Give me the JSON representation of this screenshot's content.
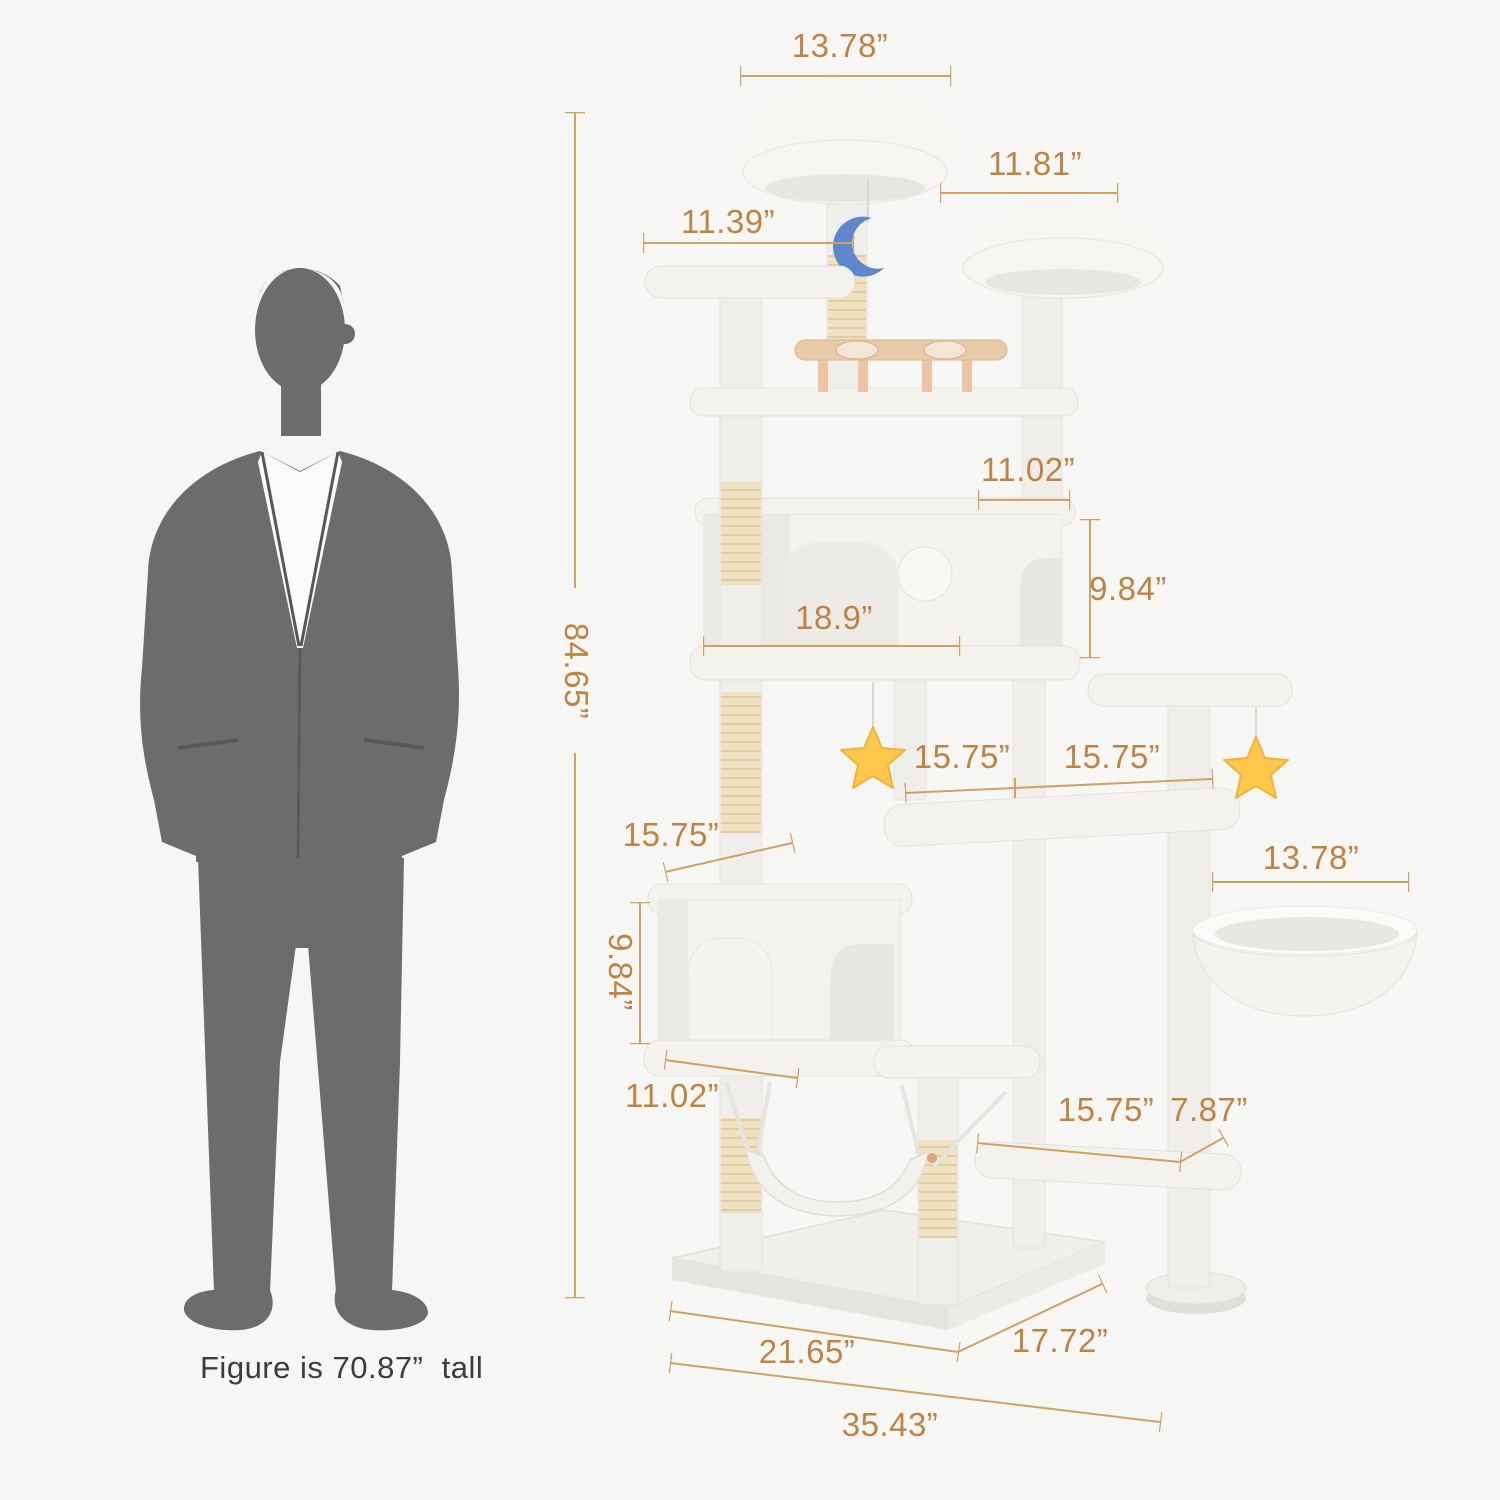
{
  "figure_note": "Figure is 70.87”  tall",
  "dimensions": [
    {
      "id": "top-cloud-width",
      "label": "13.78”"
    },
    {
      "id": "second-cloud-width",
      "label": "11.81”"
    },
    {
      "id": "left-platform-width",
      "label": "11.39”"
    },
    {
      "id": "total-height",
      "label": "84.65”"
    },
    {
      "id": "upper-condo-top-width",
      "label": "11.02”"
    },
    {
      "id": "upper-condo-height",
      "label": "9.84”"
    },
    {
      "id": "upper-condo-width",
      "label": "18.9”"
    },
    {
      "id": "corner-platform-width",
      "label": "15.75”"
    },
    {
      "id": "corner-platform-depth",
      "label": "15.75”"
    },
    {
      "id": "basket-width",
      "label": "13.78”"
    },
    {
      "id": "lower-condo-top-width",
      "label": "15.75”"
    },
    {
      "id": "lower-condo-height",
      "label": "9.84”"
    },
    {
      "id": "lower-condo-width",
      "label": "11.02”"
    },
    {
      "id": "bottom-platform-width",
      "label": "15.75”"
    },
    {
      "id": "bottom-platform-depth",
      "label": "7.87”"
    },
    {
      "id": "base-width",
      "label": "21.65”"
    },
    {
      "id": "base-depth",
      "label": "17.72”"
    },
    {
      "id": "overall-width",
      "label": "35.43”"
    }
  ],
  "colors": {
    "background": "#f6f6f4",
    "dimension_text": "#c08442",
    "dimension_line": "#cfa264",
    "figure_text": "#3c3c3e",
    "plush": "#f1f0ed",
    "plush_shade": "#e3e1dc",
    "sisal": "#efe2c0",
    "wood": "#e9cba7",
    "star_toy": "#fdc84b",
    "moon_toy": "#5e87cc",
    "silhouette": "#6c6c6e",
    "shirt": "#fbfaf9"
  }
}
